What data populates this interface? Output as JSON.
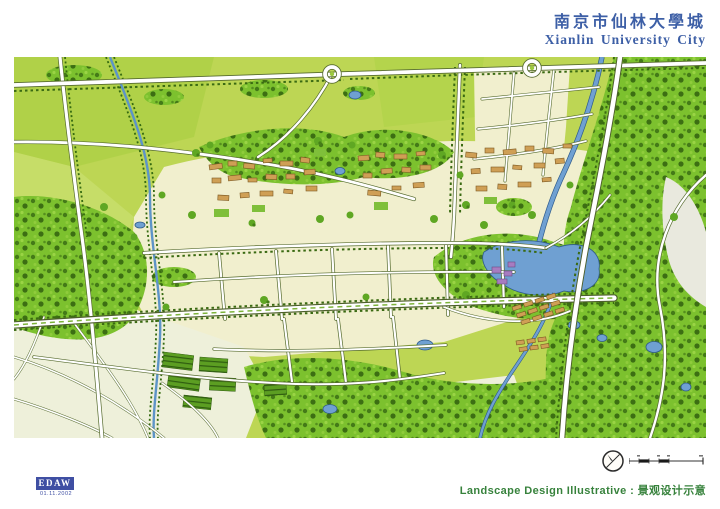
{
  "header": {
    "title_zh": "南京市仙林大學城",
    "title_en": "Xianlin University City"
  },
  "map": {
    "subject": "landscape-master-plan-illustration",
    "features": [
      "fields",
      "forest",
      "campus-buildings",
      "lake",
      "river",
      "roads",
      "highway",
      "ponds",
      "village"
    ]
  },
  "stamp": {
    "name": "EDAW",
    "date": "01.11.2002"
  },
  "legend_icons": {
    "compass": "north-arrow-icon",
    "scale_bar": "graphic-scale-icon"
  },
  "footer": {
    "caption": "Landscape Design Illustrative : 景观设计示意"
  },
  "colors": {
    "title_blue": "#3d5fa6",
    "caption_green": "#37823c",
    "stamp_blue": "#3f4fa3",
    "field_green": "#bdd654",
    "cream": "#f1efce",
    "forest_green": "#7cc12e",
    "water_blue": "#6fa0d2",
    "building_tan": "#cf9f55"
  }
}
